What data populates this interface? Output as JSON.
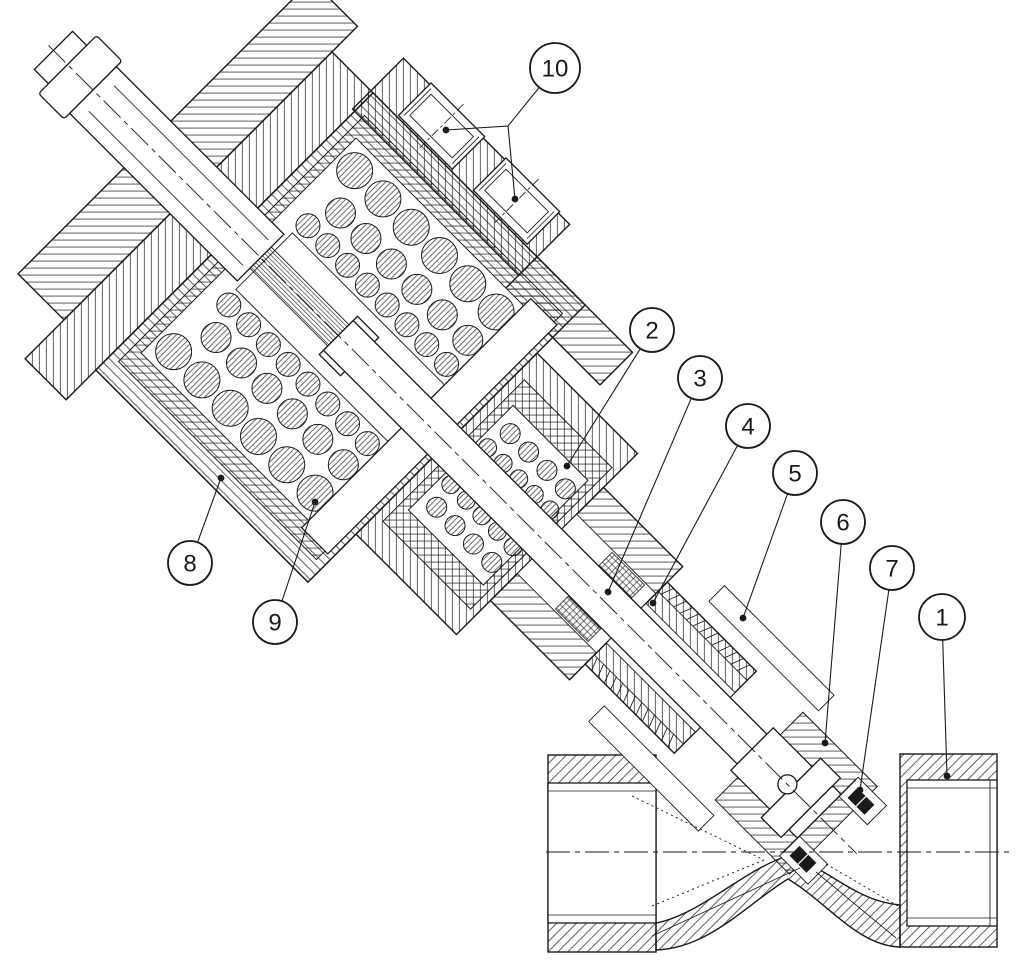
{
  "figure": {
    "background": "#ffffff",
    "line_color": "#1a1a1a",
    "balloon_radius": 22,
    "balloon_font_size": 24
  },
  "callouts": [
    {
      "label": "1",
      "cx": 942,
      "cy": 617,
      "r": 23,
      "leaders": [
        [
          942,
          617,
          947,
          776
        ]
      ]
    },
    {
      "label": "2",
      "cx": 652,
      "cy": 330,
      "r": 22,
      "leaders": [
        [
          652,
          330,
          567,
          466
        ]
      ]
    },
    {
      "label": "3",
      "cx": 700,
      "cy": 378,
      "r": 22,
      "leaders": [
        [
          700,
          378,
          608,
          592
        ]
      ]
    },
    {
      "label": "4",
      "cx": 748,
      "cy": 426,
      "r": 22,
      "leaders": [
        [
          748,
          426,
          653,
          603
        ]
      ]
    },
    {
      "label": "5",
      "cx": 795,
      "cy": 473,
      "r": 22,
      "leaders": [
        [
          795,
          473,
          743,
          618
        ]
      ]
    },
    {
      "label": "6",
      "cx": 843,
      "cy": 522,
      "r": 22,
      "leaders": [
        [
          843,
          522,
          825,
          743
        ]
      ]
    },
    {
      "label": "7",
      "cx": 892,
      "cy": 568,
      "r": 22,
      "leaders": [
        [
          892,
          568,
          860,
          790
        ]
      ]
    },
    {
      "label": "8",
      "cx": 190,
      "cy": 563,
      "r": 22,
      "leaders": [
        [
          190,
          563,
          221,
          478
        ]
      ]
    },
    {
      "label": "9",
      "cx": 275,
      "cy": 622,
      "r": 22,
      "leaders": [
        [
          275,
          622,
          315,
          502
        ]
      ]
    },
    {
      "label": "10",
      "cx": 555,
      "cy": 68,
      "r": 25,
      "leaders": [
        [
          555,
          68,
          508,
          126,
          446,
          130
        ],
        [
          508,
          126,
          515,
          199
        ]
      ]
    }
  ]
}
